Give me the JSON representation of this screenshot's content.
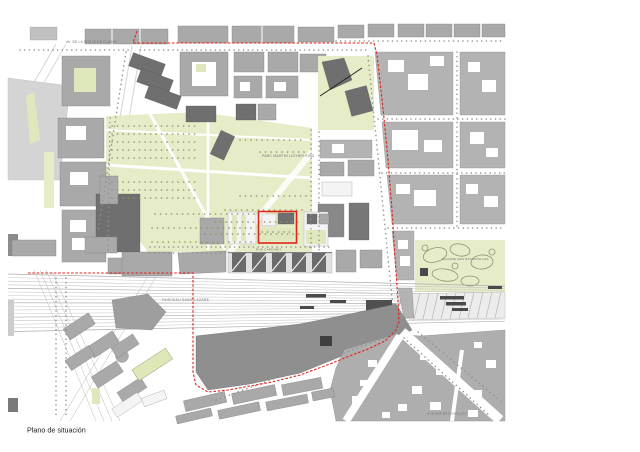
{
  "caption": "Plano de situación",
  "labels": {
    "street_top": "AV. DE LA PORTE DE CLICHY",
    "park": "PARC MARTIN LUTHER KING",
    "railway": "FAISCEAU SAINT-LAZARE",
    "square": "SQUARE DES BATIGNOLLES",
    "street_cardinet": "RUE CARDINET",
    "street_bottom": "RUE DES BATIGNOLLES"
  },
  "colors": {
    "boundary_red": "#df2418",
    "park_green": "#e7ecc8",
    "building_gray": "#a9a9a9",
    "building_dark": "#6f6f6f",
    "rail_gray": "#c5c5c5",
    "background": "#ffffff"
  }
}
